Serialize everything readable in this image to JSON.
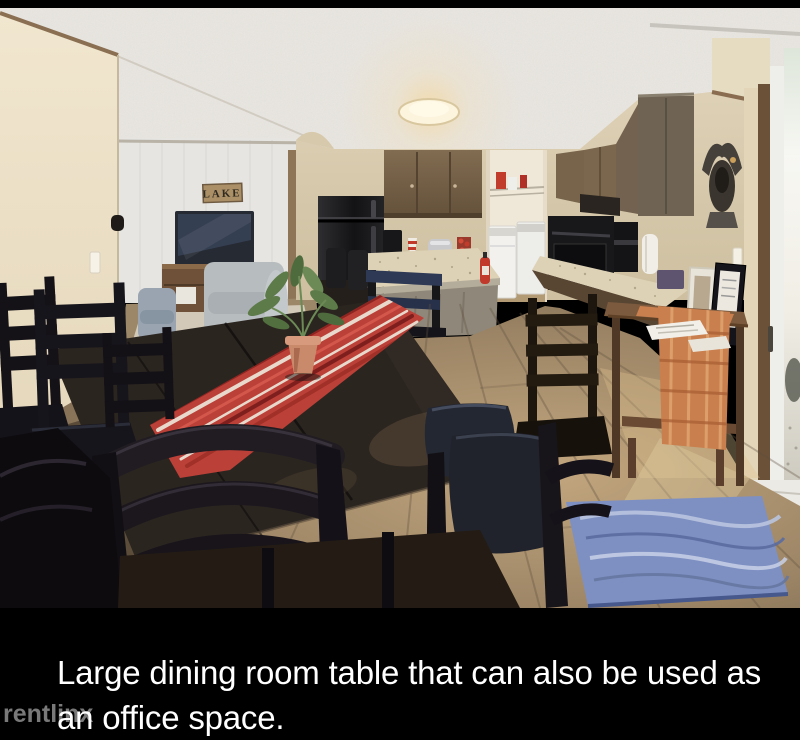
{
  "page": {
    "background": "#000000"
  },
  "caption": {
    "lines": [
      "Large dining room table that can also be used as",
      "an office space."
    ],
    "color": "#ffffff"
  },
  "watermark": {
    "text": "rentlinx",
    "color": "#8f8f8f"
  },
  "photo": {
    "description": "Open-concept dining room and kitchen: large dark dining table with red striped runner and potted plant, black ladder-back chairs, kitchen island, black refrigerator, brown cabinets, laundry closet with washer and dryer, console table with orange plaid runner, sliding glass door, blue wave rug, and living room with TV and LAKE sign",
    "lake_sign_text": "LAKE",
    "palette": {
      "ceiling_white": "#eae7e2",
      "wall_cream": "#ecdfc6",
      "wall_tan": "#d7c9ac",
      "living_wall_gray": "#e6e5e2",
      "cabinet_brown": "#75624a",
      "tall_cabinet_taupe": "#6f6354",
      "appliance_black": "#1a1a1c",
      "counter_speckle": "#ddd2b6",
      "table_espresso": "#2b2520",
      "runner_red": "#bb4038",
      "runner_stripe_cream": "#e9d9cd",
      "pot_terracotta": "#c88a6b",
      "plant_green": "#5d7a49",
      "chair_black": "#141217",
      "leather_seat": "#20232b",
      "floor_wood": "#a08866",
      "rug_blue": "#7e90c2",
      "console_wood": "#7c5a3e",
      "console_runner_orange": "#c97f4e",
      "door_light": "#f7f6f2",
      "couch_gray": "#b7bcbe",
      "armchair_blue_gray": "#99a4b0",
      "fire_extinguisher_red": "#c0392b",
      "washer_white": "#f2f1ed"
    }
  }
}
